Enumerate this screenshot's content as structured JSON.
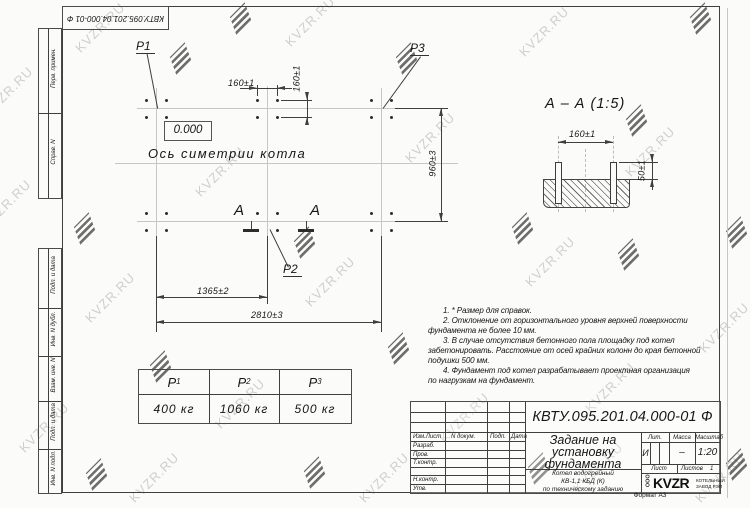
{
  "watermark": {
    "text": "KVZR.RU"
  },
  "corner_stamp": {
    "text": "КВТУ.095.201.04.000-01 Ф"
  },
  "sidebar": {
    "labels": [
      "Перв. примен.",
      "Справ. N",
      "Подп. и дата",
      "Инв. N дубл.",
      "Взам. инв. N",
      "Подп. и дата",
      "Инв. N подл."
    ]
  },
  "plan": {
    "labels": {
      "p1": "P1",
      "p2": "P2",
      "p3": "P3",
      "elevation": "0.000",
      "axis": "Ось симетрии котла",
      "section": "А"
    },
    "dims": {
      "d160h": "160±1",
      "d160v": "160±1",
      "d960": "960±3",
      "d1365": "1365±2",
      "d2810": "2810±3"
    }
  },
  "section_view": {
    "title": "А – А (1:5)",
    "dims": {
      "d160": "160±1",
      "d50": "50±1"
    }
  },
  "notes": {
    "lines": [
      "1. * Размер для справок.",
      "2. Отклонение от горизонтального уровня верхней поверхности",
      "фундамента не более 10 мм.",
      "3. В случае отсутствия бетонного пола площадку под котел",
      "забетонировать. Расстояние от осей крайних колонн до края бетонной",
      "подушки 500 мм.",
      "4. Фундамент под котел разрабатывает проектная организация",
      "по нагрузкам на фундамент."
    ]
  },
  "load_table": {
    "headers": [
      {
        "base": "P",
        "sub": "1"
      },
      {
        "base": "P",
        "sub": "2"
      },
      {
        "base": "P",
        "sub": "3"
      }
    ],
    "values": [
      "400 кг",
      "1060 кг",
      "500 кг"
    ]
  },
  "title_block": {
    "designation": "КВТУ.095.201.04.000-01 Ф",
    "title_lines": [
      "Задание на",
      "установку",
      "фундамента"
    ],
    "product_lines": [
      "Котел водогрейный",
      "КВ-1,1 КБД (К)",
      "по техническому заданию"
    ],
    "col_headers": {
      "izm": "Изм.Лист",
      "dok": "N докум.",
      "podp": "Подп.",
      "data": "Дата"
    },
    "row_labels": [
      "Разраб.",
      "Пров.",
      "Т.контр.",
      "Н.контр.",
      "Утв."
    ],
    "lit": {
      "label": "Лит.",
      "value": "И"
    },
    "mass": {
      "label": "Масса",
      "value": "–"
    },
    "scale": {
      "label": "Масштаб",
      "value": "1:20"
    },
    "sheet": {
      "list_label": "Лист",
      "listov_label": "Листов",
      "listov_value": "1"
    },
    "company": {
      "ooo": "ООО",
      "brand": "KVZR",
      "line1": "КОТЕЛЬНЫЙ",
      "line2": "ЗАВОД РЭП"
    },
    "format": "Формат А3"
  }
}
